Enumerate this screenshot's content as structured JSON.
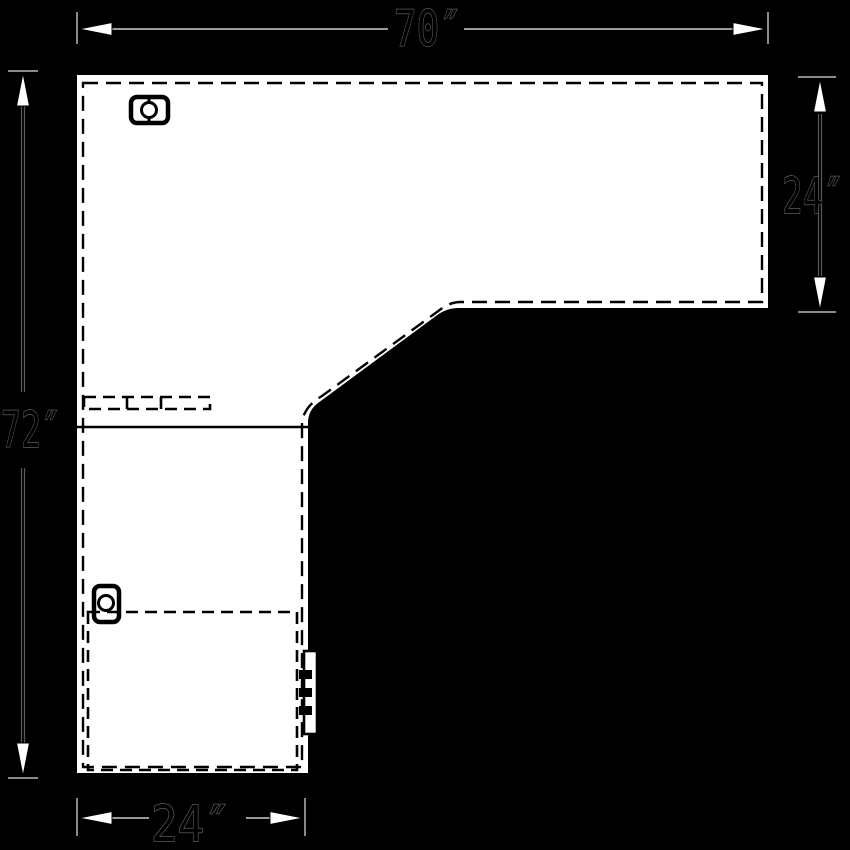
{
  "drawing": {
    "description": "Plan-view technical drawing of an L-shaped desk / worksurface",
    "dimensions": {
      "top": "70″",
      "right": "24″",
      "left": "72″",
      "bottom": "24″"
    },
    "colors": {
      "background": "#000000",
      "surface": "#ffffff",
      "linework": "#000000",
      "dimension_line": "#9a9a9a",
      "arrowhead_fill": "#ffffff"
    },
    "symbols": {
      "grommet_top": "grommet-icon",
      "grommet_left": "grommet-icon",
      "hidden_tray": "hidden-tray-outline",
      "hidden_rail": "hidden-rail-outline",
      "seam": "seam-line",
      "bracket": "edge-bracket"
    }
  }
}
